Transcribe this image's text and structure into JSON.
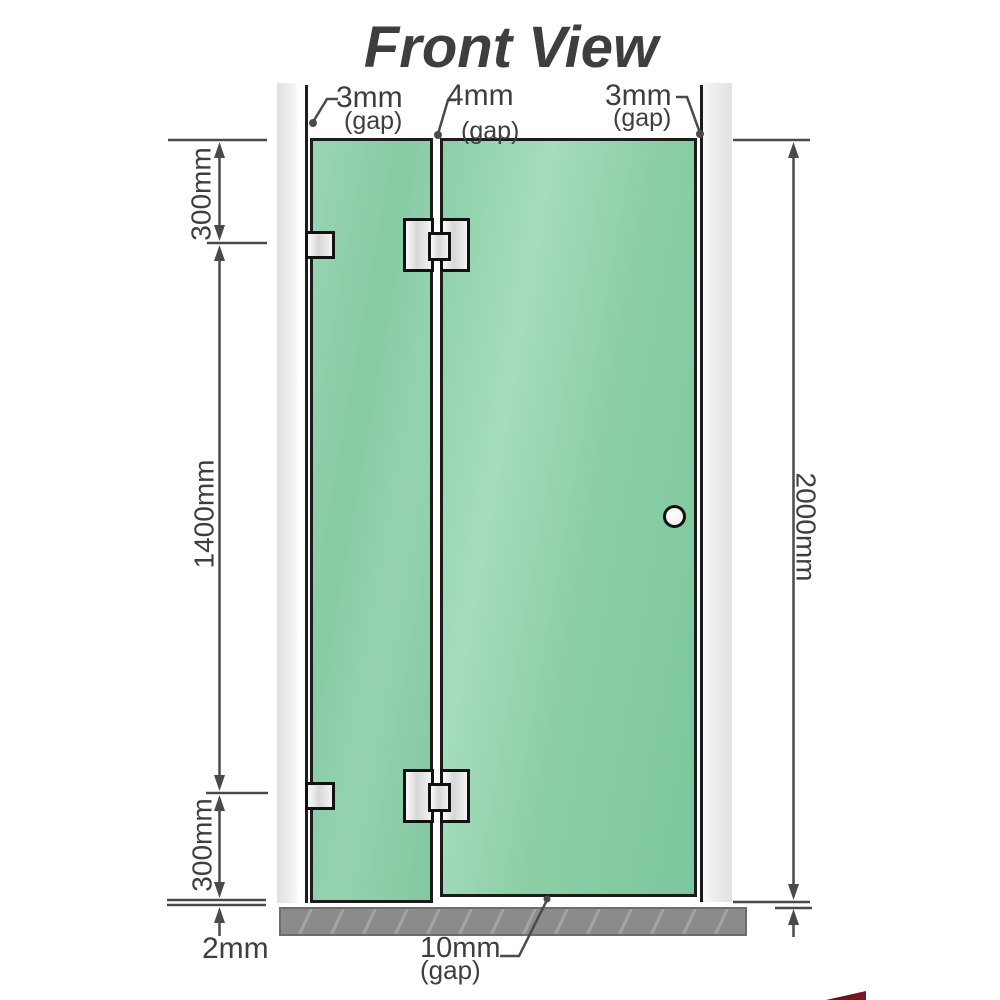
{
  "title": "Front View",
  "gaps": {
    "top_left": {
      "value": "3mm",
      "note": "(gap)"
    },
    "top_middle": {
      "value": "4mm",
      "note": "(gap)"
    },
    "top_right": {
      "value": "3mm",
      "note": "(gap)"
    },
    "bottom": {
      "value": "10mm",
      "note": "(gap)"
    }
  },
  "dimensions": {
    "left_top": "300mm",
    "left_middle": "1400mm",
    "left_bottom": "300mm",
    "left_floor_gap": "2mm",
    "right_height": "2000mm"
  },
  "colors": {
    "glass": "#85cba3",
    "glass-light": "#a9ddc0",
    "wall": "#e6e6e6",
    "floor": "#8b8b8b",
    "outline": "#1c1c1c",
    "dim": "#4a4a4a",
    "text": "#3e3e3e",
    "title": "#9b9b9b",
    "logo": "#7d1824"
  }
}
